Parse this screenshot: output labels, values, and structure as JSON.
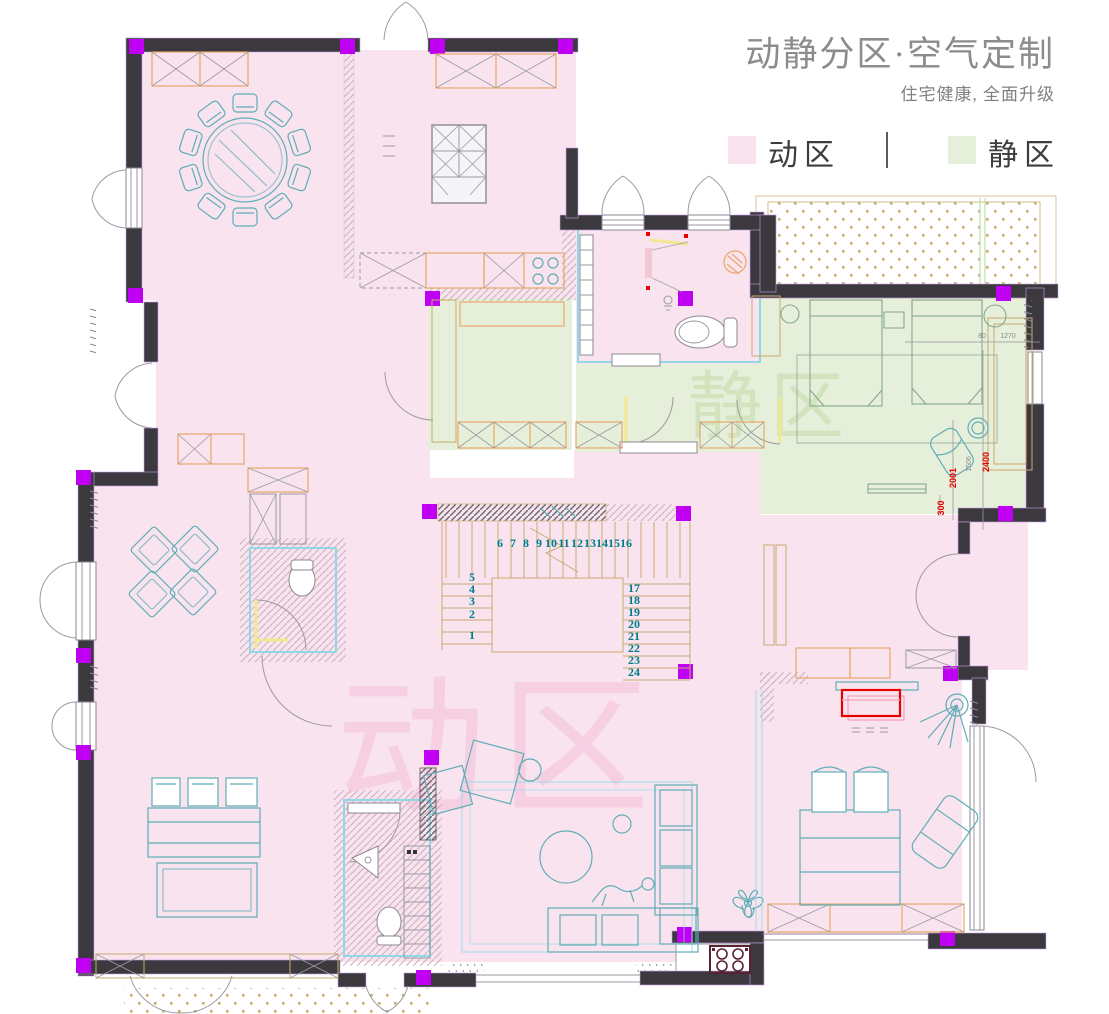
{
  "header": {
    "title": "动静分区·空气定制",
    "subtitle": "住宅健康, 全面升级"
  },
  "legend": {
    "divider": "|",
    "items": [
      {
        "label": "动区",
        "color": "#f9e3ef"
      },
      {
        "label": "静区",
        "color": "#e6efda"
      }
    ]
  },
  "watermarks": {
    "active": "动区",
    "quiet": "静区"
  },
  "stairs": {
    "top_row": [
      "6",
      "7",
      "8",
      "9",
      "10",
      "11",
      "12",
      "13",
      "14",
      "15",
      "16"
    ],
    "left_col": [
      "5",
      "4",
      "3",
      "2",
      "1"
    ],
    "right_col": [
      "17",
      "18",
      "19",
      "20",
      "21",
      "22",
      "23",
      "24"
    ]
  },
  "dimensions": {
    "d2400": "2400",
    "d2001": "2001",
    "d300": "300",
    "d1506": "1506",
    "d1270": "1270",
    "d80": "80"
  },
  "colors": {
    "active_zone": "#f9e3ef",
    "quiet_zone": "#e6efda",
    "wall": "#3b393d",
    "column_marker": "#bf00f2",
    "furniture_line": "#5fadb6",
    "cabinet_line": "#e8a768",
    "stair_number": "#007d8a",
    "dimension_red": "#e60000",
    "title_gray": "#8c8c8e"
  }
}
